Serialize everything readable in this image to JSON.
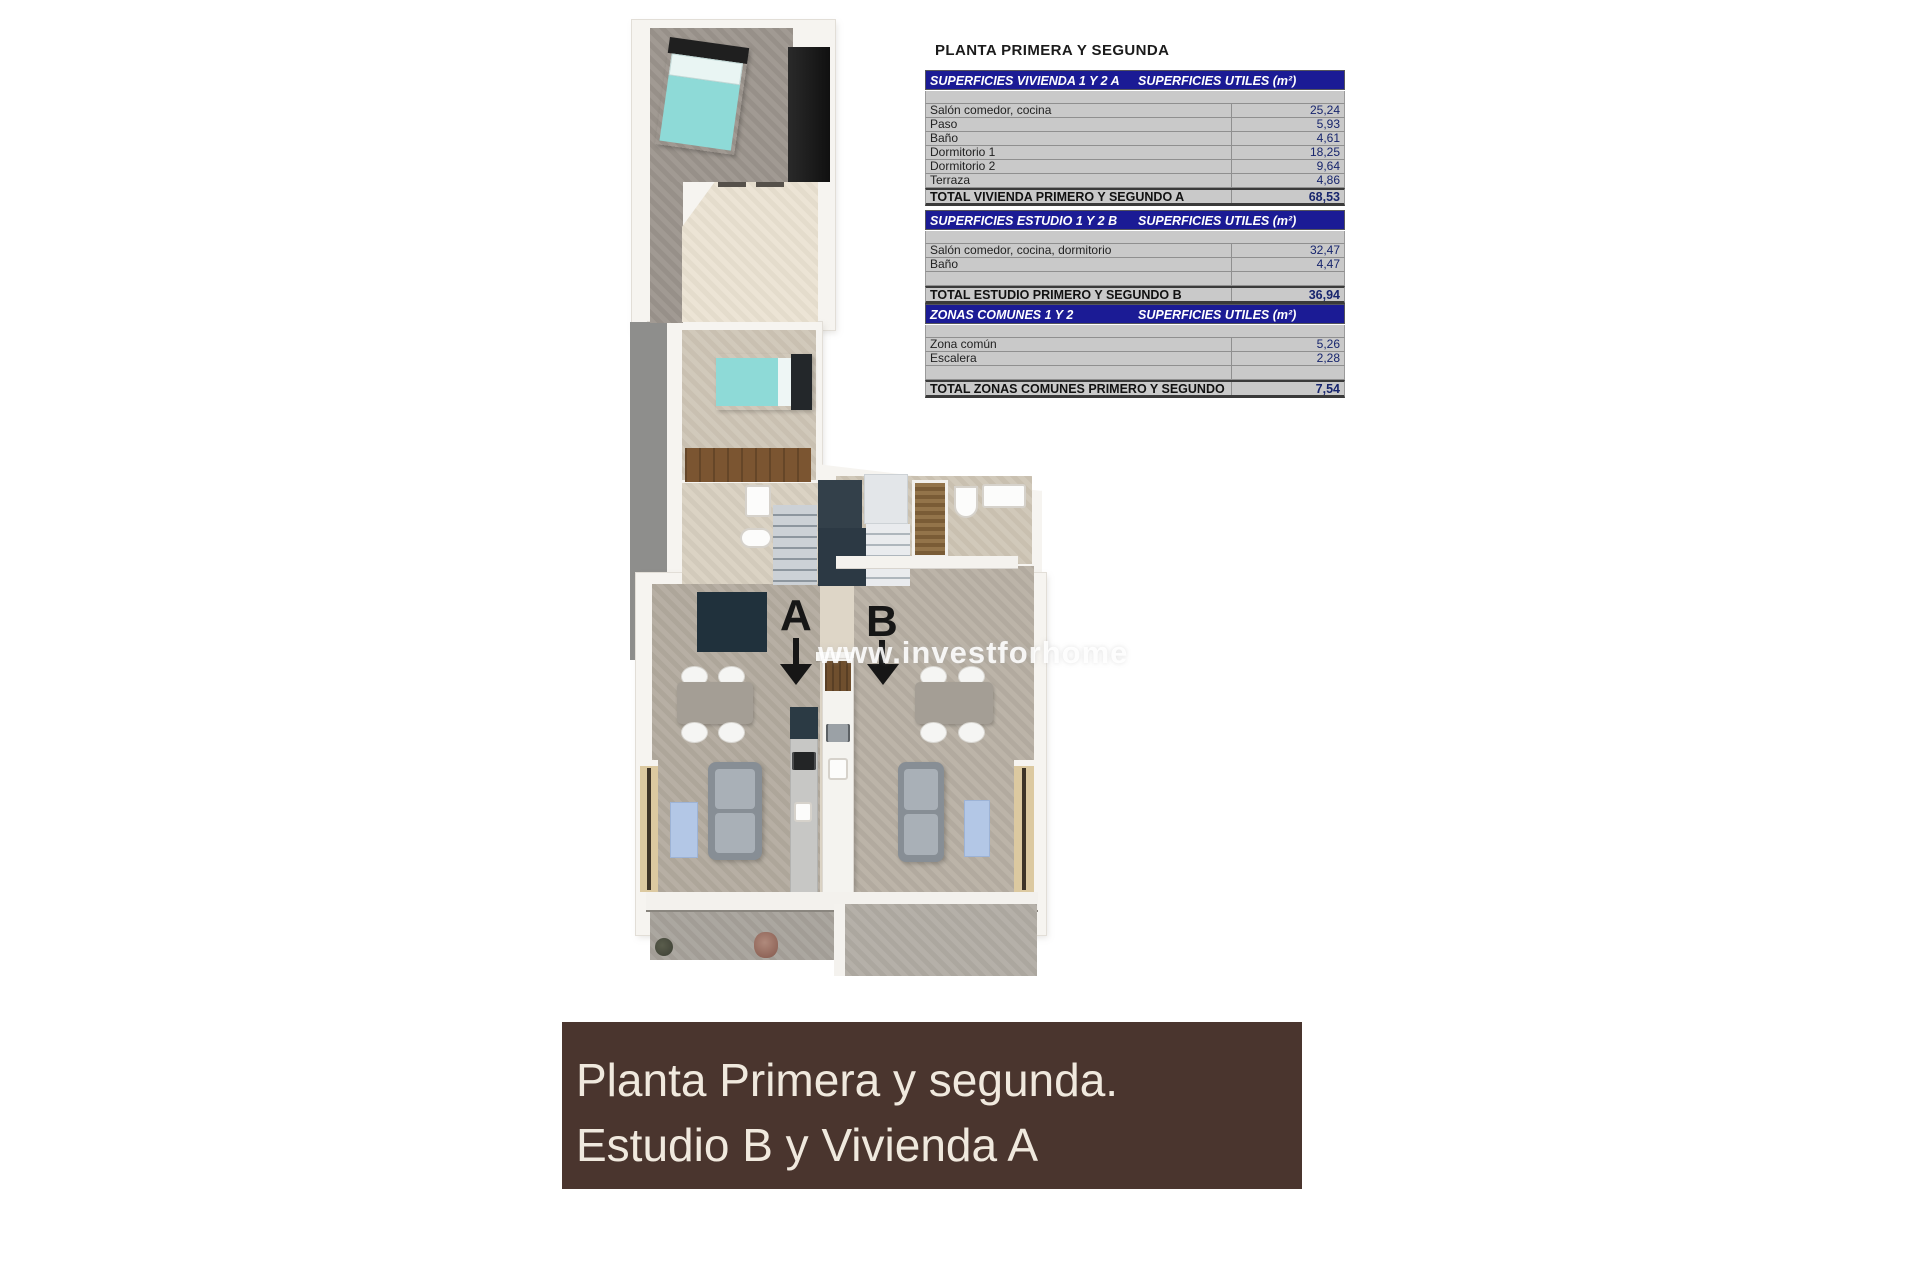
{
  "title": "PLANTA PRIMERA Y SEGUNDA",
  "tables": [
    {
      "name": "SUPERFICIES VIVIENDA 1 Y 2 A",
      "unit_header": "SUPERFICIES UTILES  (m²)",
      "rows": [
        {
          "label": "Salón comedor, cocina",
          "value": "25,24"
        },
        {
          "label": "Paso",
          "value": "5,93"
        },
        {
          "label": "Baño",
          "value": "4,61"
        },
        {
          "label": "Dormitorio 1",
          "value": "18,25"
        },
        {
          "label": "Dormitorio 2",
          "value": "9,64"
        },
        {
          "label": "Terraza",
          "value": "4,86"
        }
      ],
      "total_label": "TOTAL VIVIENDA PRIMERO Y SEGUNDO A",
      "total_value": "68,53"
    },
    {
      "name": "SUPERFICIES ESTUDIO 1 Y 2 B",
      "unit_header": "SUPERFICIES UTILES  (m²)",
      "rows": [
        {
          "label": "Salón comedor, cocina, dormitorio",
          "value": "32,47"
        },
        {
          "label": "Baño",
          "value": "4,47"
        },
        {
          "label": "",
          "value": ""
        }
      ],
      "total_label": "TOTAL ESTUDIO PRIMERO Y SEGUNDO B",
      "total_value": "36,94"
    },
    {
      "name": "ZONAS COMUNES 1 Y 2",
      "unit_header": "SUPERFICIES UTILES  (m²)",
      "rows": [
        {
          "label": "Zona común",
          "value": "5,26"
        },
        {
          "label": "Escalera",
          "value": "2,28"
        },
        {
          "label": "",
          "value": ""
        }
      ],
      "total_label": "TOTAL ZONAS COMUNES PRIMERO Y SEGUNDO",
      "total_value": "7,54"
    }
  ],
  "plan": {
    "letter_a": "A",
    "letter_b": "B",
    "watermark": "www.investforhome"
  },
  "banner": {
    "line1": "Planta Primera y segunda.",
    "line2": "Estudio B y Vivienda A",
    "background": "#4a352e",
    "text_color": "#f0e9de"
  },
  "colors": {
    "table_header_bg": "#1b1b95",
    "table_row_bg": "#c9c9c9",
    "table_value_text": "#17256d"
  }
}
